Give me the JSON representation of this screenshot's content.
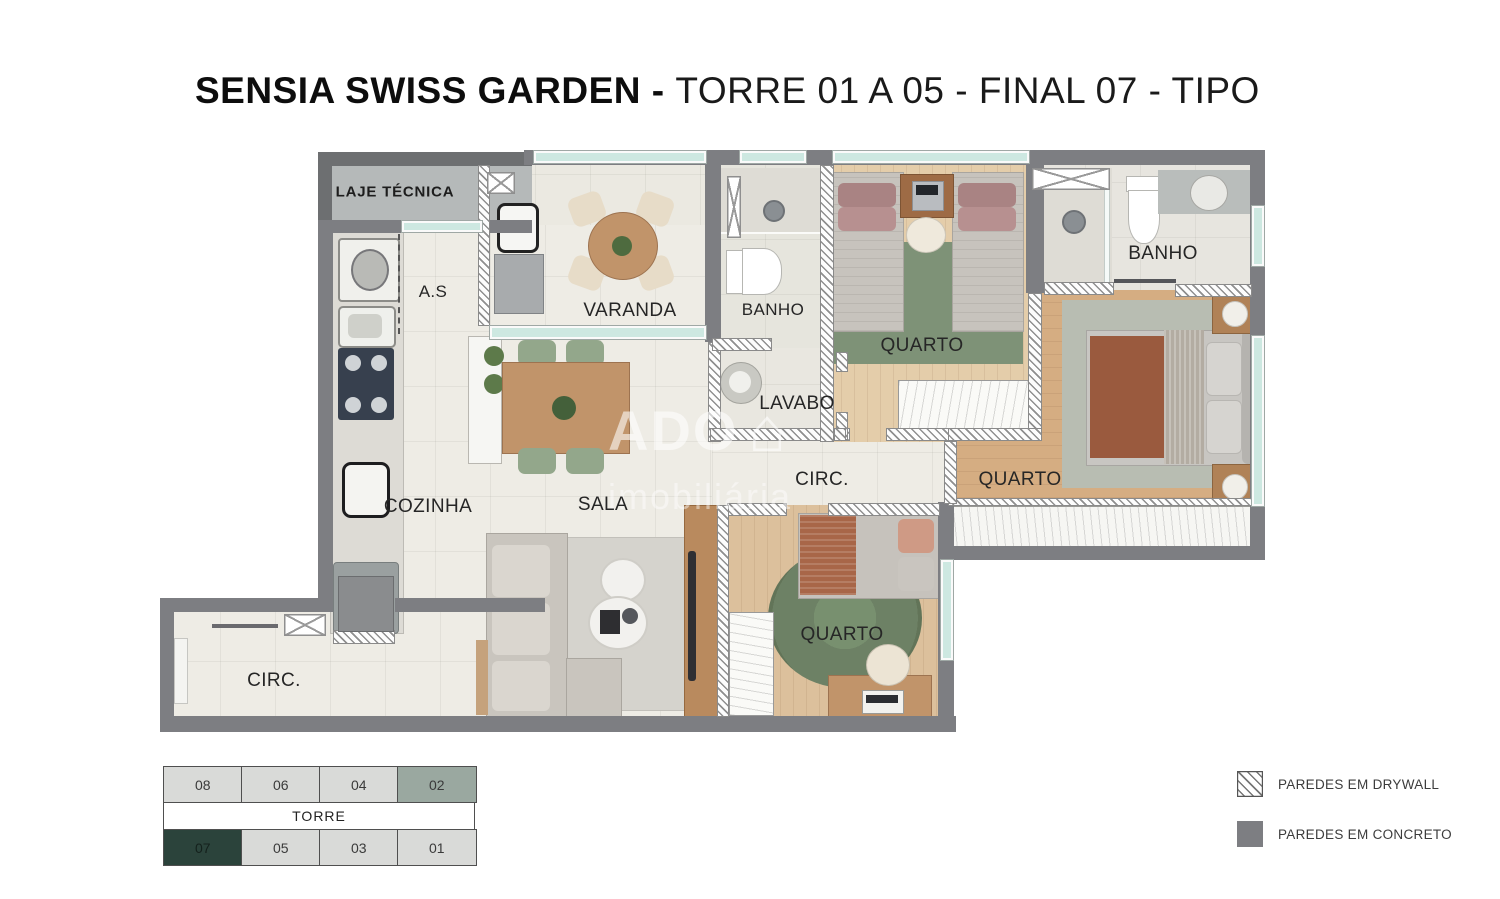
{
  "title": {
    "main": "SENSIA SWISS GARDEN - ",
    "sub": "TORRE 01 A 05 - FINAL 07 - TIPO"
  },
  "floorplan": {
    "rooms": {
      "laje_tecnica": "LAJE TÉCNICA",
      "servico": "A.S",
      "varanda": "VARANDA",
      "banho_social": "BANHO",
      "quarto_duplo": "QUARTO",
      "banho_suite": "BANHO",
      "lavabo": "LAVABO",
      "circ_interna": "CIRC.",
      "quarto_casal": "QUARTO",
      "cozinha": "COZINHA",
      "sala": "SALA",
      "quarto_solteiro": "QUARTO",
      "circ_entrada": "CIRC."
    }
  },
  "tower_diagram": {
    "label": "TORRE",
    "top_row": [
      "08",
      "06",
      "04",
      "02"
    ],
    "bottom_row": [
      "07",
      "05",
      "03",
      "01"
    ],
    "highlighted_unit": "07",
    "secondary_highlight_unit": "02",
    "highlight_color": "#2b433b",
    "secondary_highlight_color": "#9aa8a0"
  },
  "legend": {
    "items": [
      {
        "label": "PAREDES EM DRYWALL",
        "style": "drywall-hatch"
      },
      {
        "label": "PAREDES EM CONCRETO",
        "style": "concrete-solid"
      }
    ]
  },
  "watermark": {
    "text": "ADO",
    "sub": "imobiliária",
    "icon": "house"
  },
  "colors": {
    "wall_concrete": "#7d7e82",
    "floor_tile": "#eeece5",
    "floor_wood": "#d5ad82",
    "rug_green": "#7e9277",
    "window_glass": "#cde8e1",
    "laje_fill": "#b5b9b9"
  }
}
